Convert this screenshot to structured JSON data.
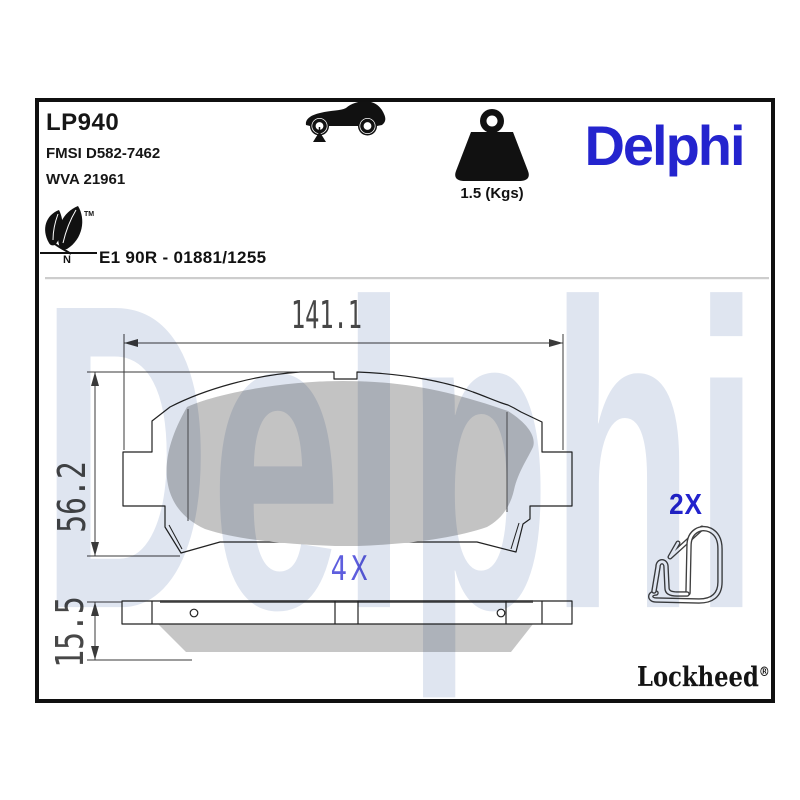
{
  "header": {
    "sku": "LP940",
    "fmsi": "FMSI D582-7462",
    "wva": "WVA 21961"
  },
  "weight": {
    "value": "1.5 (Kgs)"
  },
  "brand": {
    "name": "Delphi",
    "color": "#2424ce"
  },
  "homologation": {
    "code": "E1 90R - 01881/1255",
    "eco_letter": "N",
    "trademark": "TM"
  },
  "watermark": {
    "text": "Delphi",
    "color": "#dfe5f0"
  },
  "drawing": {
    "width_mm": "141.1",
    "height_mm": "56.2",
    "thickness_mm": "15.5",
    "pad_quantity": "4X",
    "clip_quantity": "2X",
    "annotation_blue": "#5e5ede",
    "clip_blue": "#2323cd",
    "friction_gray": "#c3c3c3"
  },
  "footer": {
    "brand": "Lockheed",
    "registered": "®"
  },
  "icons": {
    "car": "car-side-icon",
    "weight": "weight-icon",
    "eco": "eco-leaves-icon",
    "clip": "retaining-clip-drawing"
  }
}
